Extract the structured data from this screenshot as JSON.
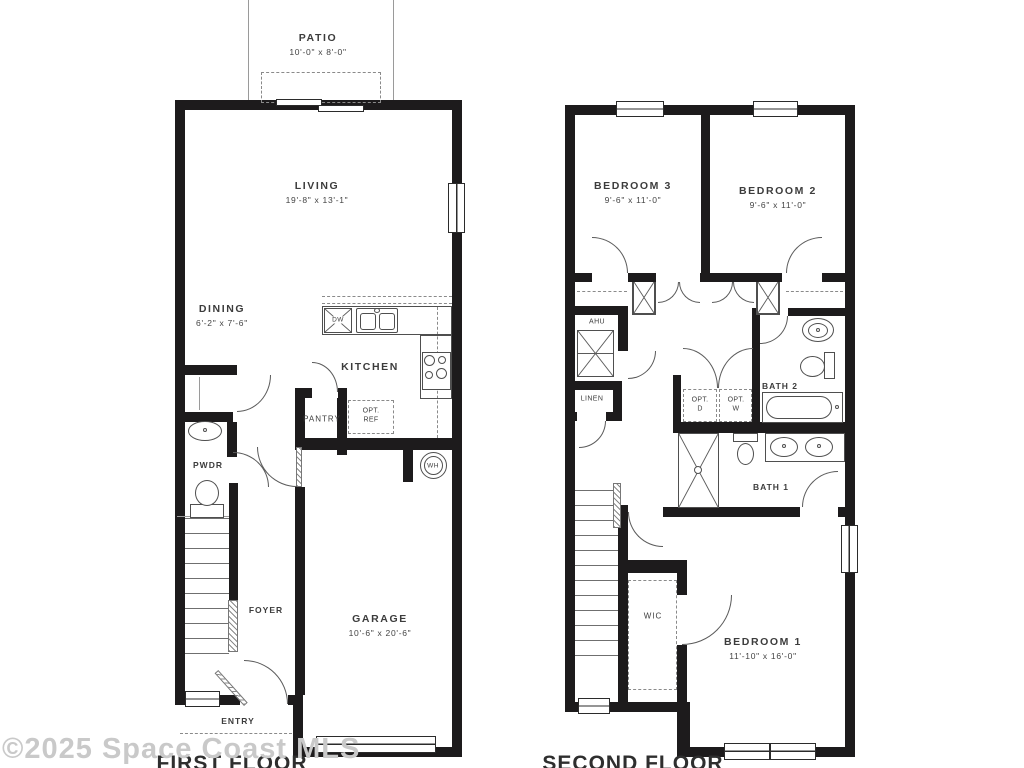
{
  "watermark": "©2025 Space Coast MLS",
  "first_floor": {
    "caption": "FIRST FLOOR",
    "rooms": {
      "patio": {
        "label": "PATIO",
        "dims": "10'-0\" x 8'-0\""
      },
      "living": {
        "label": "LIVING",
        "dims": "19'-8\" x 13'-1\""
      },
      "dining": {
        "label": "DINING",
        "dims": "6'-2\" x 7'-6\""
      },
      "kitchen": {
        "label": "KITCHEN"
      },
      "pantry": {
        "label": "PANTRY"
      },
      "pwdr": {
        "label": "PWDR"
      },
      "foyer": {
        "label": "FOYER"
      },
      "garage": {
        "label": "GARAGE",
        "dims": "10'-6\" x 20'-6\""
      },
      "entry": {
        "label": "ENTRY"
      }
    },
    "fixtures": {
      "dishwasher": "DW",
      "water_heater": "WH",
      "opt_ref": {
        "line1": "OPT.",
        "line2": "REF"
      }
    }
  },
  "second_floor": {
    "caption": "SECOND FLOOR",
    "rooms": {
      "bedroom3": {
        "label": "BEDROOM 3",
        "dims": "9'-6\" x 11'-0\""
      },
      "bedroom2": {
        "label": "BEDROOM 2",
        "dims": "9'-6\" x 11'-0\""
      },
      "bedroom1": {
        "label": "BEDROOM 1",
        "dims": "11'-10\" x 16'-0\""
      },
      "bath1": {
        "label": "BATH 1"
      },
      "bath2": {
        "label": "BATH 2"
      },
      "ahu": {
        "label": "AHU"
      },
      "linen": {
        "label": "LINEN"
      },
      "wic": {
        "label": "WIC"
      }
    },
    "fixtures": {
      "opt_dryer": {
        "line1": "OPT.",
        "line2": "D"
      },
      "opt_washer": {
        "line1": "OPT.",
        "line2": "W"
      }
    }
  },
  "colors": {
    "wall": "#1d1b1c",
    "fixture_line": "#4f4f4f",
    "label": "#3c3c3c",
    "watermark": "#c9c9c9"
  }
}
